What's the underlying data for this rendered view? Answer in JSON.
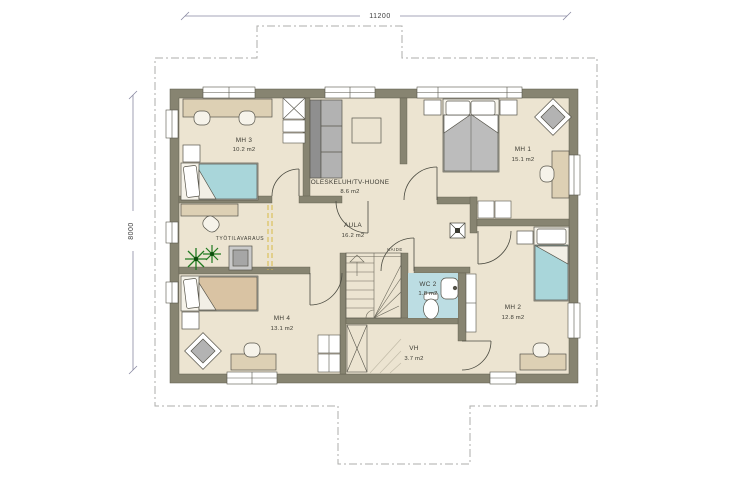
{
  "drawing": {
    "type": "floor-plan",
    "dimensions": {
      "width_mm": "11200",
      "height_mm": "8000"
    },
    "rooms": [
      {
        "id": "mh3",
        "name": "MH 3",
        "area": "10.2 m2"
      },
      {
        "id": "olesk",
        "name": "OLESKELUH/TV-HUONE",
        "area": "8.6 m2"
      },
      {
        "id": "mh1",
        "name": "MH 1",
        "area": "15.1 m2"
      },
      {
        "id": "aula",
        "name": "AULA",
        "area": "16.2 m2"
      },
      {
        "id": "tyo",
        "name": "TYÖTILAVARAUS",
        "area": ""
      },
      {
        "id": "wc2",
        "name": "WC 2",
        "area": "1.8 m2"
      },
      {
        "id": "mh2",
        "name": "MH 2",
        "area": "12.8 m2"
      },
      {
        "id": "mh4",
        "name": "MH 4",
        "area": "13.1 m2"
      },
      {
        "id": "vh",
        "name": "VH",
        "area": "3.7 m2"
      }
    ],
    "annotations": {
      "stair_railing": "KAIDE"
    },
    "colors": {
      "wall": "#878471",
      "floor": "#ece4d1",
      "wc_floor": "#bcdde3",
      "bed_teal": "#a9d6da",
      "bed_tan": "#d9c3a3",
      "bed_gray": "#bcbcbc",
      "desk_tan": "#ddd0b4",
      "plant_green": "#207a20",
      "zone_dash_yellow": "#d9ba45",
      "eave_dash": "#adadab",
      "dim_line": "#8888a0"
    }
  }
}
